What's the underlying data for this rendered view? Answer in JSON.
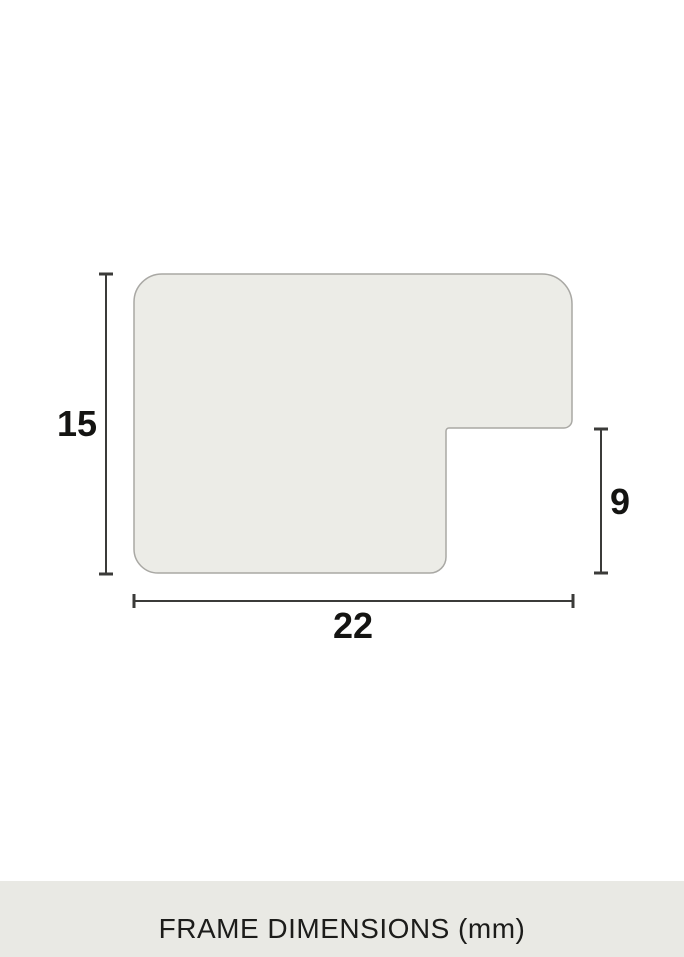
{
  "diagram": {
    "caption": "FRAME DIMENSIONS (mm)",
    "unit": "mm",
    "dimensions": {
      "height": "15",
      "width": "22",
      "depth": "9"
    },
    "colors": {
      "background": "#FFFFFF",
      "profile_fill": "#ECECE7",
      "profile_stroke": "#A9A8A4",
      "dimension_line": "#3B3B39",
      "label_text": "#141412",
      "caption_bar_bg": "#E9E9E4",
      "caption_text": "#1C1C1A"
    }
  }
}
